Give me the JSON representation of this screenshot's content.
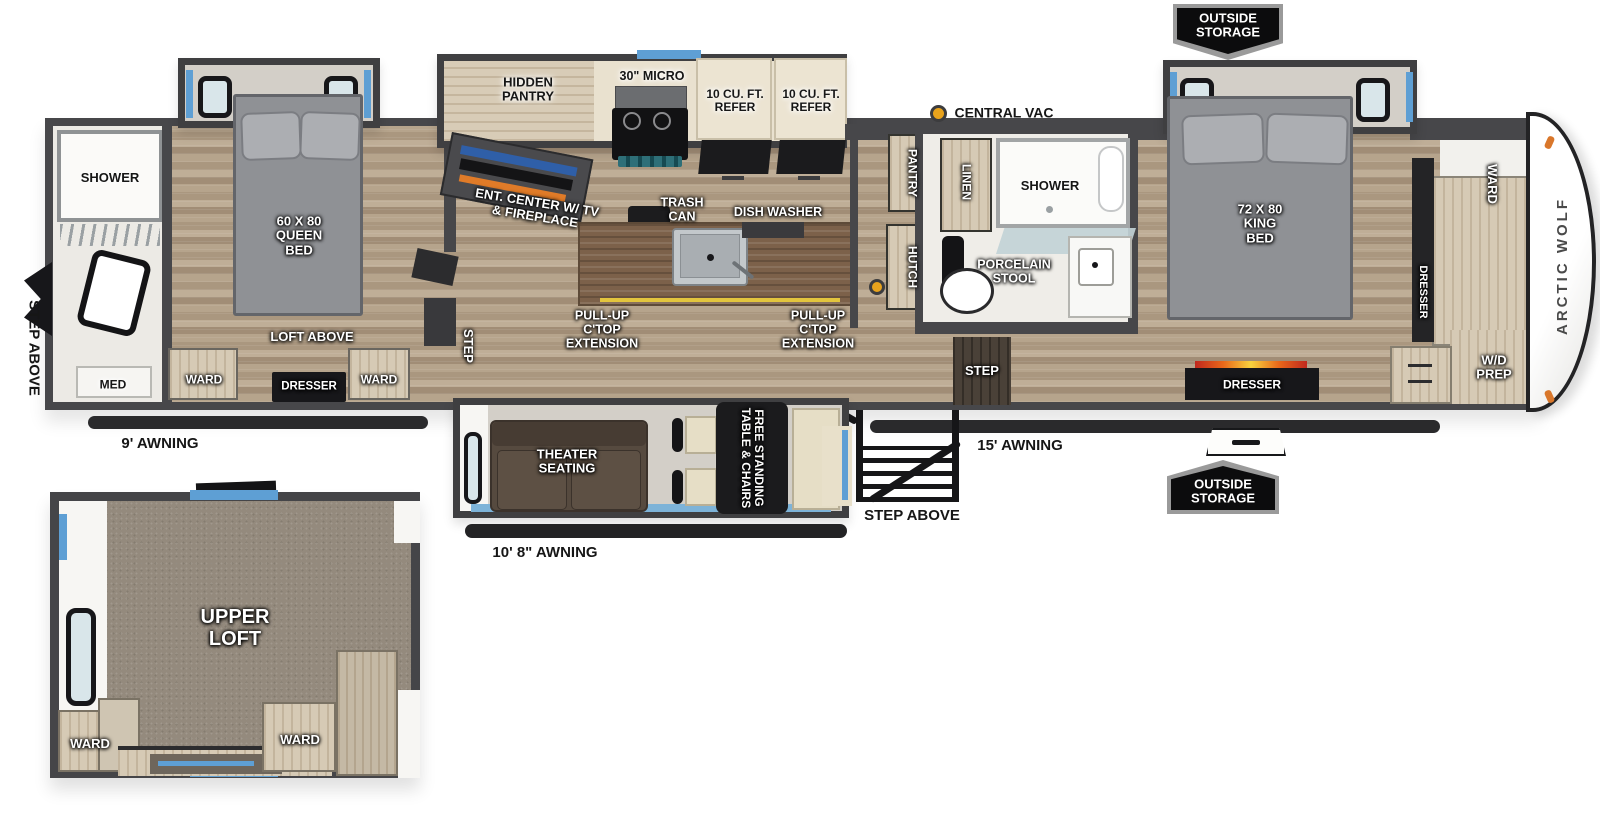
{
  "plan": {
    "brand": "ARCTIC WOLF",
    "outside_storage_top": "OUTSIDE\nSTORAGE",
    "outside_storage_bottom": "OUTSIDE\nSTORAGE",
    "exterior": {
      "awning_rear": "9' AWNING",
      "awning_mid": "10' 8\" AWNING",
      "awning_front": "15' AWNING",
      "step_above_rear": "STEP ABOVE",
      "step_above_entry": "STEP ABOVE",
      "central_vac": "CENTRAL VAC"
    },
    "rear_bath": {
      "shower": "SHOWER",
      "med": "MED"
    },
    "rear_bedroom": {
      "bed": "60 X 80\nQUEEN\nBED",
      "loft_above": "LOFT ABOVE",
      "ward_left": "WARD",
      "dresser": "DRESSER",
      "ward_right": "WARD"
    },
    "kitchen": {
      "hidden_pantry": "HIDDEN\nPANTRY",
      "micro": "30\" MICRO",
      "refer_left": "10 CU. FT.\nREFER",
      "refer_right": "10 CU. FT.\nREFER",
      "ent_center": "ENT. CENTER W/ TV\n& FIREPLACE",
      "trash_can": "TRASH\nCAN",
      "dish_washer": "DISH WASHER",
      "ctop_left": "PULL-UP\nC'TOP\nEXTENSION",
      "ctop_right": "PULL-UP\nC'TOP\nEXTENSION",
      "pantry": "PANTRY",
      "hutch": "HUTCH",
      "step": "STEP"
    },
    "mid_bath": {
      "linen": "LINEN",
      "shower": "SHOWER",
      "porcelain_stool": "PORCELAIN\nSTOOL",
      "step": "STEP"
    },
    "front_bedroom": {
      "bed": "72 X 80\nKING\nBED",
      "dresser_bottom": "DRESSER",
      "ward": "WARD",
      "dresser_side": "DRESSER",
      "wd_prep": "W/D\nPREP"
    },
    "living": {
      "theater": "THEATER\nSEATING",
      "table": "FREE STANDING\nTABLE & CHAIRS"
    },
    "loft": {
      "title": "UPPER\nLOFT",
      "ward_left": "WARD",
      "ward_right": "WARD"
    },
    "colors": {
      "wall": "#47474a",
      "accent_blue": "#5e9fd4",
      "vac_dot": "#e8a31d"
    }
  }
}
